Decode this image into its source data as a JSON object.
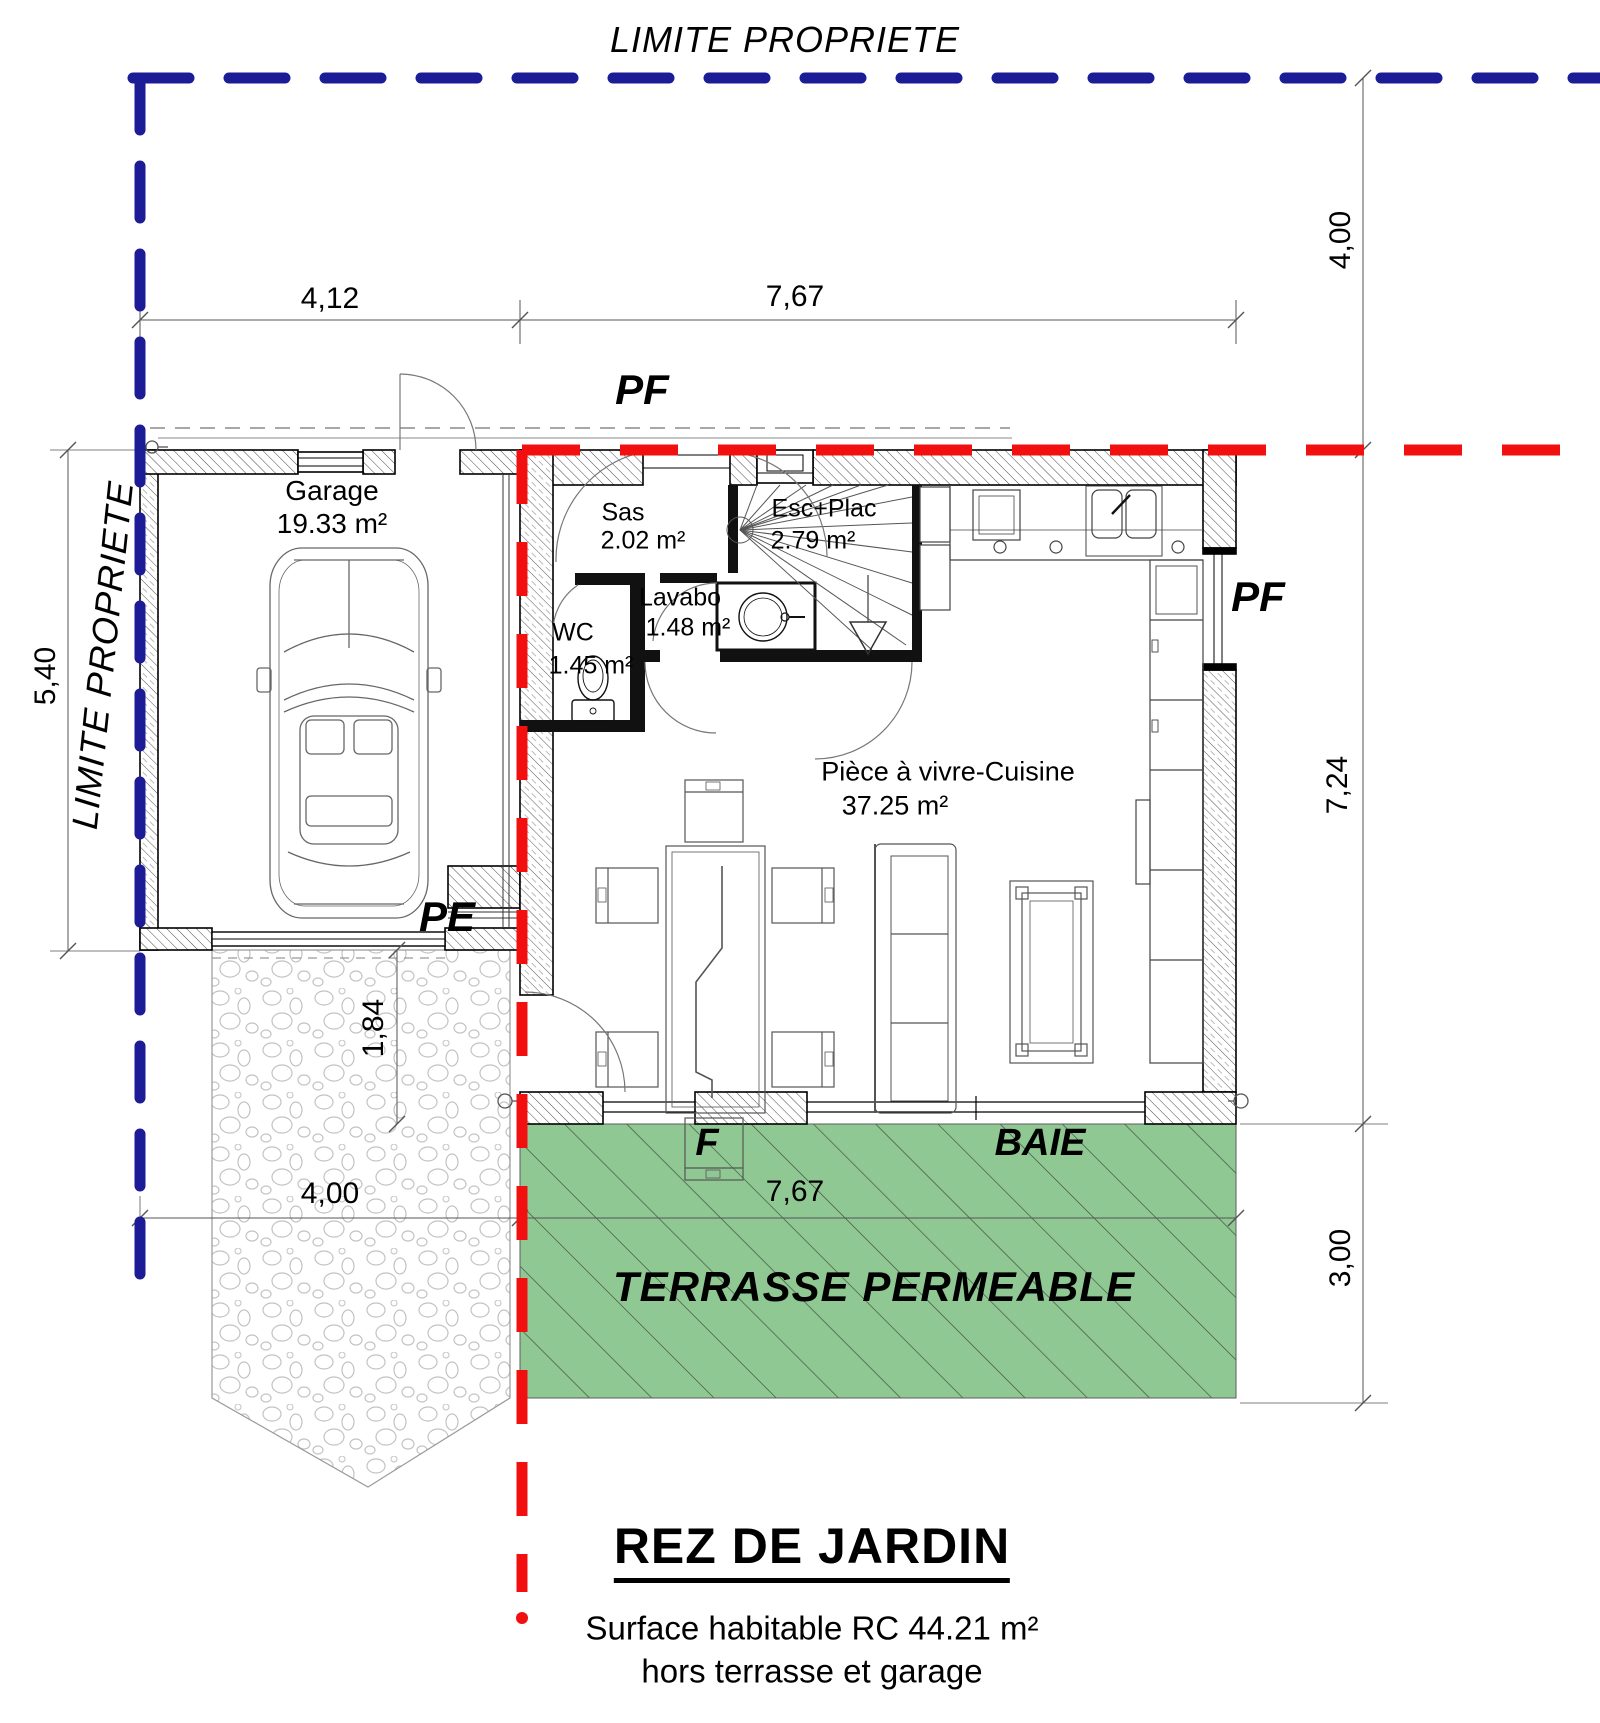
{
  "drawing": {
    "boundary_label_top": "LIMITE PROPRIETE",
    "boundary_label_left": "LIMITE PROPRIETE",
    "plan_title": "REZ DE JARDIN",
    "surface_note_line1": "Surface habitable RC 44.21 m²",
    "surface_note_line2": "hors terrasse et garage",
    "terrace_label": "TERRASSE PERMEABLE"
  },
  "rooms": {
    "garage": {
      "name": "Garage",
      "area": "19.33 m²"
    },
    "sas": {
      "name": "Sas",
      "area": "2.02 m²"
    },
    "esc_plac": {
      "name": "Esc+Plac",
      "area": "2.79 m²"
    },
    "lavabo": {
      "name": "Lavabo",
      "area": "1.48 m²"
    },
    "wc": {
      "name": "WC",
      "area": "1.45 m²"
    },
    "living": {
      "name": "Pièce à vivre-Cuisine",
      "area": "37.25 m²"
    }
  },
  "openings": {
    "pf_top": "PF",
    "pf_right": "PF",
    "pe": "PE",
    "window_f": "F",
    "bay": "BAIE"
  },
  "dimensions": {
    "garage_width": "4,12",
    "house_width_top": "7,67",
    "setback_top": "4,00",
    "house_depth": "7,24",
    "terrace_depth": "3,00",
    "garage_depth": "5,40",
    "path_width": "1,84",
    "driveway_width": "4,00",
    "terrace_width": "7,67"
  },
  "colors": {
    "property_line_blue": "#1c1c96",
    "project_line_red": "#f20f0f",
    "terrace_green": "#8fc892"
  }
}
